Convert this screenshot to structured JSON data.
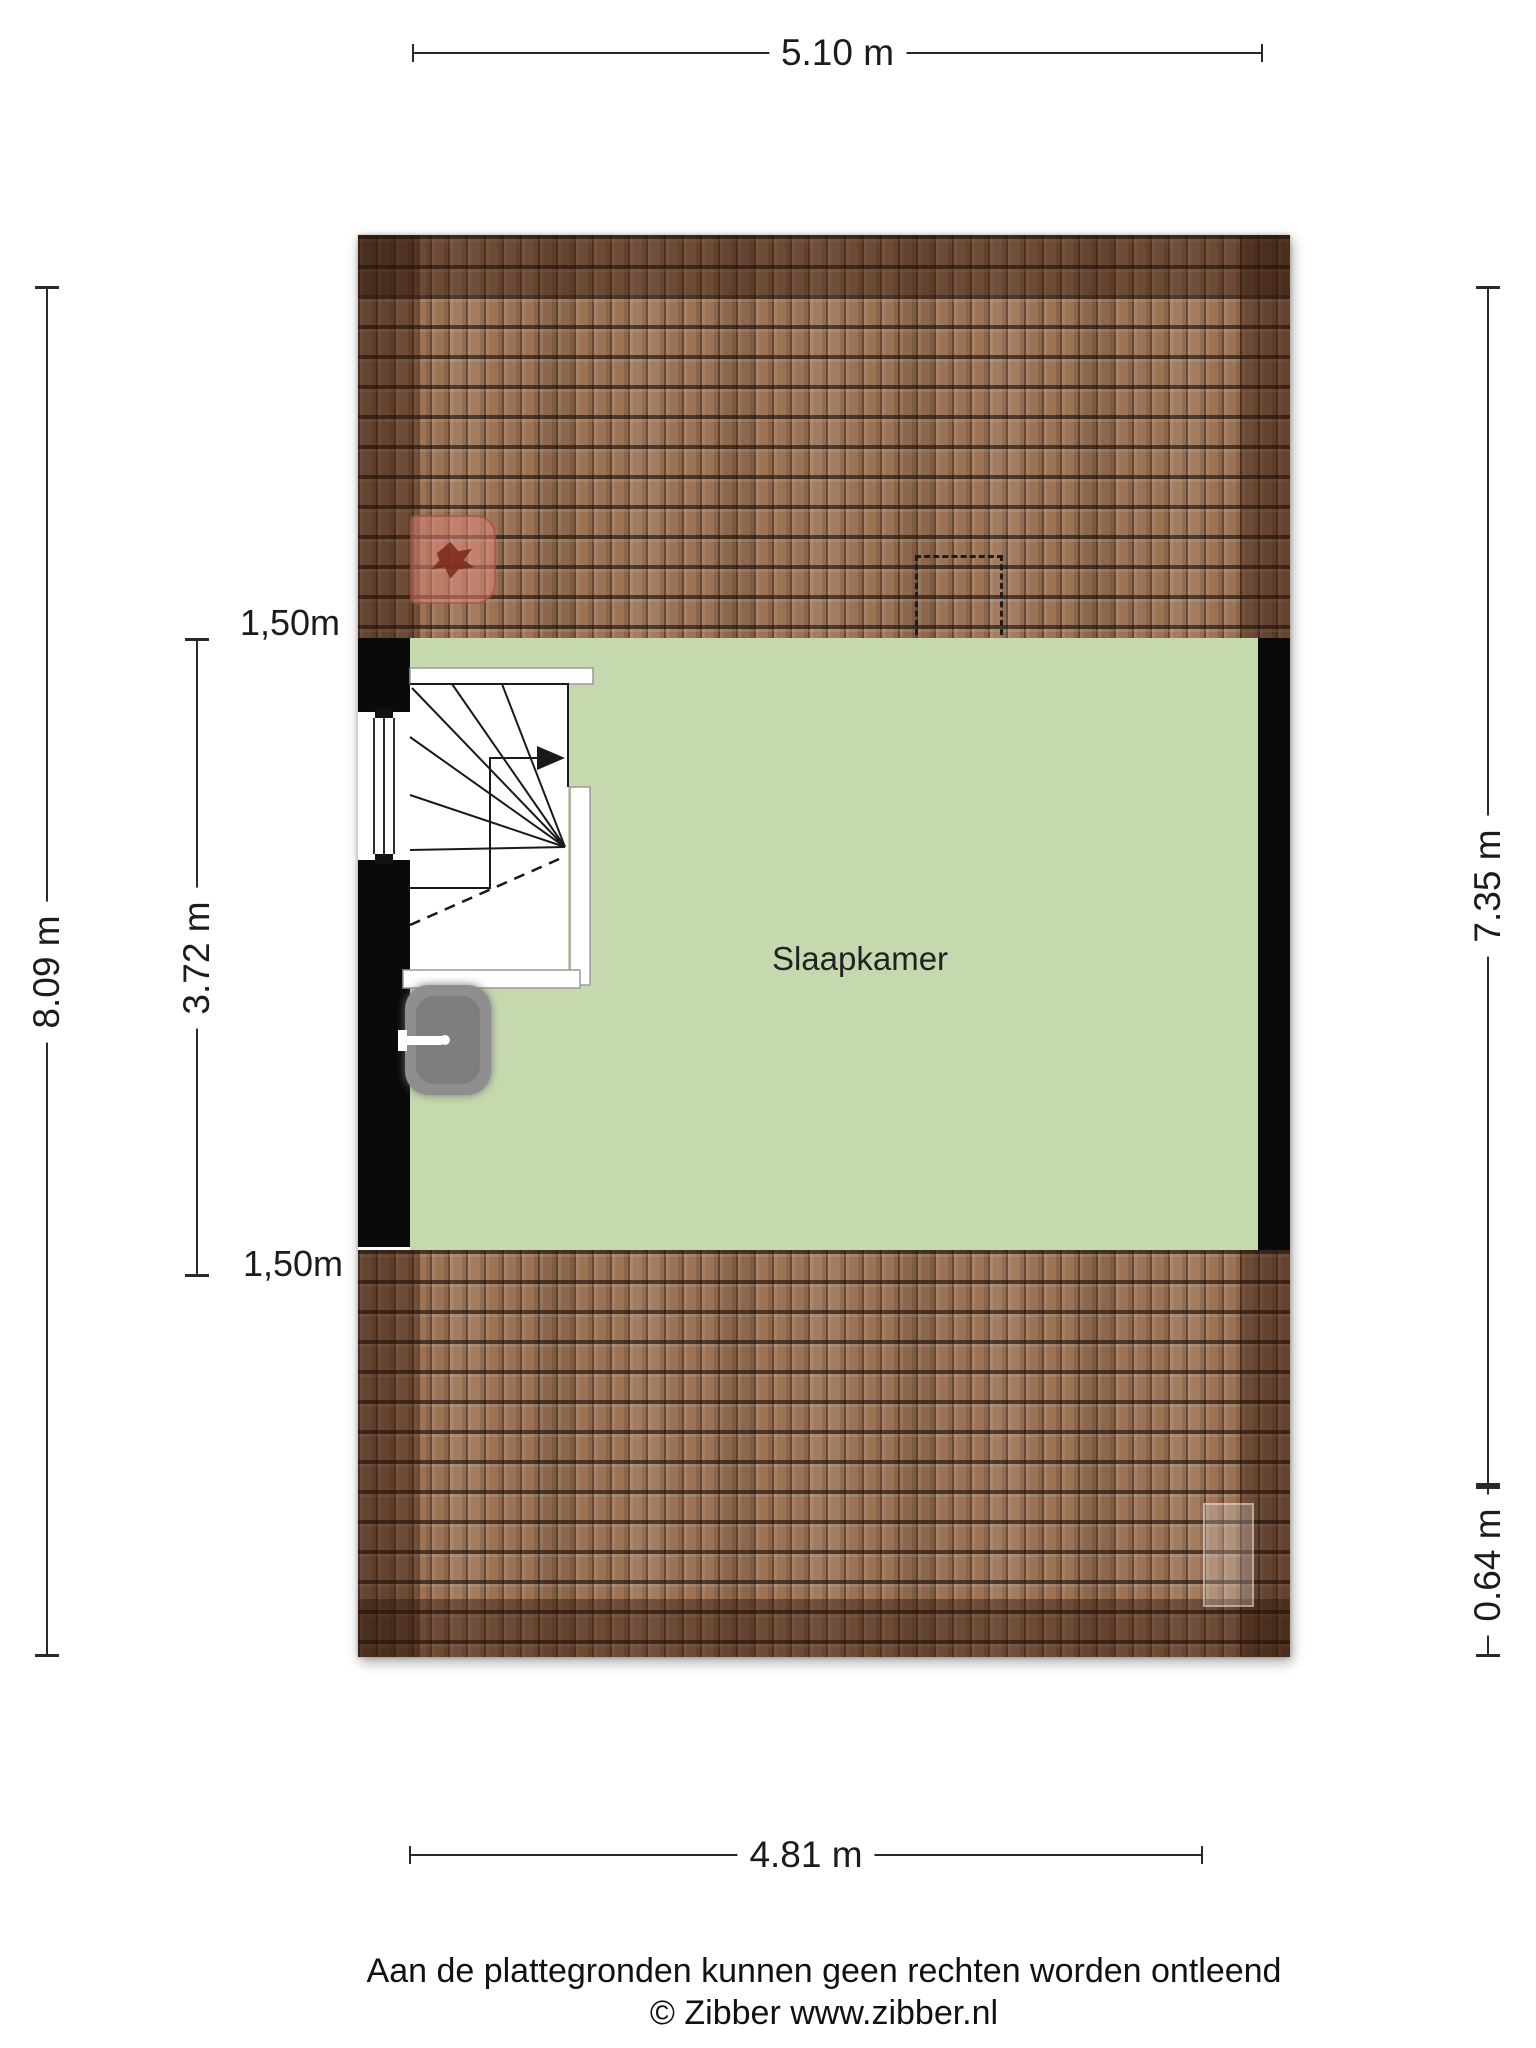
{
  "dimensions": {
    "top_width": "5.10 m",
    "bottom_width": "4.81 m",
    "left_total_height": "8.09 m",
    "left_room_height": "3.72 m",
    "right_total_height": "7.35 m",
    "right_roof_depth": "0.64 m",
    "knee_wall_top": "1,50m",
    "knee_wall_bottom": "1,50m"
  },
  "rooms": [
    {
      "name": "Slaapkamer"
    }
  ],
  "footer": {
    "disclaimer": "Aan de plattegronden kunnen geen rechten worden ontleend",
    "copyright": "© Zibber www.zibber.nl"
  },
  "icons": {
    "stairs_direction": "arrow-right",
    "sink_faucet": "faucet-left"
  },
  "colors": {
    "room_fill": "#c6d9ae",
    "roof_tile": "#9d7355",
    "roof_shade": "rgba(43,20,8,0.42)",
    "wall": "#0a0a0a",
    "dimension": "#2a2a2a",
    "roof_window_fill": "rgba(224,136,122,0.5)"
  }
}
